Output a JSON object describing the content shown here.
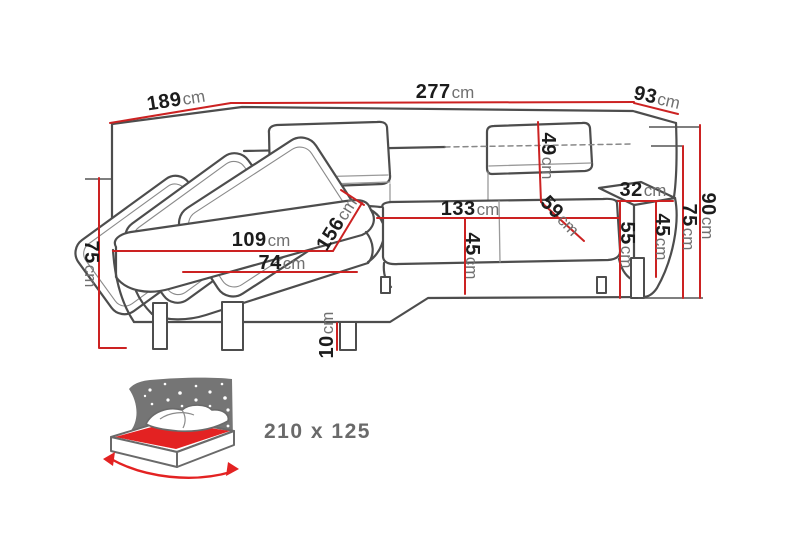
{
  "dims": {
    "total_width": {
      "value": "277",
      "unit": "cm"
    },
    "back_depth_left": {
      "value": "189",
      "unit": "cm"
    },
    "back_depth_right": {
      "value": "93",
      "unit": "cm"
    },
    "back_height": {
      "value": "90",
      "unit": "cm"
    },
    "armrest_height_right": {
      "value": "75",
      "unit": "cm"
    },
    "armrest_width_right": {
      "value": "32",
      "unit": "cm"
    },
    "armrest_inner_height_right": {
      "value": "45",
      "unit": "cm"
    },
    "armrest_front_height_right": {
      "value": "55",
      "unit": "cm"
    },
    "headrest_height": {
      "value": "49",
      "unit": "cm"
    },
    "backrest_depth": {
      "value": "59",
      "unit": "cm"
    },
    "seat_width": {
      "value": "133",
      "unit": "cm"
    },
    "seat_height": {
      "value": "45",
      "unit": "cm"
    },
    "chaise_length": {
      "value": "156",
      "unit": "cm"
    },
    "chaise_width": {
      "value": "109",
      "unit": "cm"
    },
    "chaise_cushion_width": {
      "value": "74",
      "unit": "cm"
    },
    "leg_height": {
      "value": "10",
      "unit": "cm"
    },
    "side_height_left": {
      "value": "75",
      "unit": "cm"
    }
  },
  "sleeping_area": {
    "label": "210 x 125"
  },
  "colors": {
    "dimension_line": "#cc2222",
    "sofa_outline": "#4d4d4d",
    "label_number": "#1c1c1c",
    "label_unit": "#707070",
    "bed_accent": "#e32222",
    "icon_gray": "#757575",
    "bed_text": "#6a6a6a"
  }
}
